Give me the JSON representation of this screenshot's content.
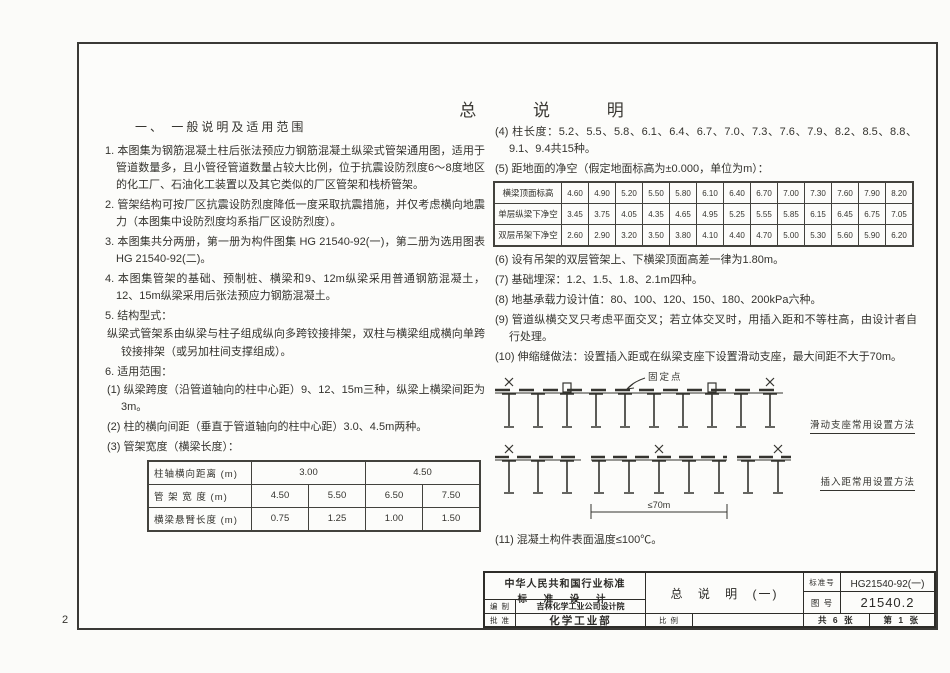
{
  "page": {
    "number": "2",
    "title": "总 说 明"
  },
  "left": {
    "heading": "一、 一般说明及适用范围",
    "items": [
      "1. 本图集为钢筋混凝土柱后张法预应力钢筋混凝土纵梁式管架通用图，适用于管道数量多，且小管径管道数量占较大比例，位于抗震设防烈度6～8度地区的化工厂、石油化工装置以及其它类似的厂区管架和栈桥管架。",
      "2. 管架结构可按厂区抗震设防烈度降低一度采取抗震措施，并仅考虑横向地震力（本图集中设防烈度均系指厂区设防烈度）。",
      "3. 本图集共分两册，第一册为构件图集 HG 21540-92(一)，第二册为选用图表 HG 21540-92(二)。",
      "4. 本图集管架的基础、预制桩、横梁和9、12m纵梁采用普通钢筋混凝土，12、15m纵梁采用后张法预应力钢筋混凝土。",
      "5. 结构型式：",
      "纵梁式管架系由纵梁与柱子组成纵向多跨铰接排架，双柱与横梁组成横向单跨铰接排架（或另加柱间支撑组成）。",
      "6. 适用范围：",
      "(1) 纵梁跨度（沿管道轴向的柱中心距）9、12、15m三种，纵梁上横梁间距为3m。",
      "(2) 柱的横向间距（垂直于管道轴向的柱中心距）3.0、4.5m两种。",
      "(3) 管架宽度（横梁长度）："
    ]
  },
  "right": {
    "items": [
      "(4) 柱长度：5.2、5.5、5.8、6.1、6.4、6.7、7.0、7.3、7.6、7.9、8.2、8.5、8.8、9.1、9.4共15种。",
      "(5) 距地面的净空（假定地面标高为±0.000，单位为m）：",
      "(6) 设有吊架的双层管架上、下横梁顶面高差一律为1.80m。",
      "(7) 基础埋深：1.2、1.5、1.8、2.1m四种。",
      "(8) 地基承载力设计值：80、100、120、150、180、200kPa六种。",
      "(9) 管道纵横交叉只考虑平面交叉；若立体交叉时，用插入距和不等柱高，由设计者自行处理。",
      "(10) 伸缩缝做法：设置插入距或在纵梁支座下设置滑动支座，最大间距不大于70m。",
      "(11) 混凝土构件表面温度≤100℃。"
    ]
  },
  "tables": {
    "width_table": {
      "rows": [
        {
          "cells": [
            {
              "t": "柱轴横向距离 (m)",
              "label": true
            },
            {
              "t": "3.00",
              "span": 2
            },
            {
              "t": "4.50",
              "span": 2
            }
          ]
        },
        {
          "cells": [
            {
              "t": "管 架 宽 度 (m)",
              "label": true
            },
            {
              "t": "4.50"
            },
            {
              "t": "5.50"
            },
            {
              "t": "6.50"
            },
            {
              "t": "7.50"
            }
          ]
        },
        {
          "cells": [
            {
              "t": "横梁悬臂长度 (m)",
              "label": true
            },
            {
              "t": "0.75"
            },
            {
              "t": "1.25"
            },
            {
              "t": "1.00"
            },
            {
              "t": "1.50"
            }
          ]
        }
      ]
    },
    "clearance_table": {
      "rows": [
        {
          "cells": [
            {
              "t": "横梁顶面标高",
              "label": true
            },
            {
              "t": "4.60"
            },
            {
              "t": "4.90"
            },
            {
              "t": "5.20"
            },
            {
              "t": "5.50"
            },
            {
              "t": "5.80"
            },
            {
              "t": "6.10"
            },
            {
              "t": "6.40"
            },
            {
              "t": "6.70"
            },
            {
              "t": "7.00"
            },
            {
              "t": "7.30"
            },
            {
              "t": "7.60"
            },
            {
              "t": "7.90"
            },
            {
              "t": "8.20"
            }
          ]
        },
        {
          "cells": [
            {
              "t": "单层纵梁下净空",
              "label": true
            },
            {
              "t": "3.45"
            },
            {
              "t": "3.75"
            },
            {
              "t": "4.05"
            },
            {
              "t": "4.35"
            },
            {
              "t": "4.65"
            },
            {
              "t": "4.95"
            },
            {
              "t": "5.25"
            },
            {
              "t": "5.55"
            },
            {
              "t": "5.85"
            },
            {
              "t": "6.15"
            },
            {
              "t": "6.45"
            },
            {
              "t": "6.75"
            },
            {
              "t": "7.05"
            }
          ]
        },
        {
          "cells": [
            {
              "t": "双层吊架下净空",
              "label": true
            },
            {
              "t": "2.60"
            },
            {
              "t": "2.90"
            },
            {
              "t": "3.20"
            },
            {
              "t": "3.50"
            },
            {
              "t": "3.80"
            },
            {
              "t": "4.10"
            },
            {
              "t": "4.40"
            },
            {
              "t": "4.70"
            },
            {
              "t": "5.00"
            },
            {
              "t": "5.30"
            },
            {
              "t": "5.60"
            },
            {
              "t": "5.90"
            },
            {
              "t": "6.20"
            }
          ]
        }
      ]
    }
  },
  "diagrams": {
    "fixed_point": "固定点",
    "sliding_caption": "滑动支座常用设置方法",
    "insertion_caption": "插入距常用设置方法",
    "dimension": "≤70m"
  },
  "title_block": {
    "standard_line1": "中华人民共和国行业标准",
    "standard_line2": "标 准 设 计",
    "compile_label": "编 制",
    "compile_value": "吉林化学工业公司设计院",
    "approve_label": "批 准",
    "approve_value": "化学工业部",
    "drawing_title": "总 说 明 (一)",
    "scale_label": "比 例",
    "scale_value": "",
    "standard_no_label": "标准号",
    "standard_no": "HG21540-92(一)",
    "figure_no_label": "图 号",
    "figure_no": "21540.2",
    "sheets_total": "共 6 张",
    "sheet_no": "第 1 张"
  },
  "colors": {
    "ink": "#34332e",
    "paper": "#fcfcfa"
  }
}
